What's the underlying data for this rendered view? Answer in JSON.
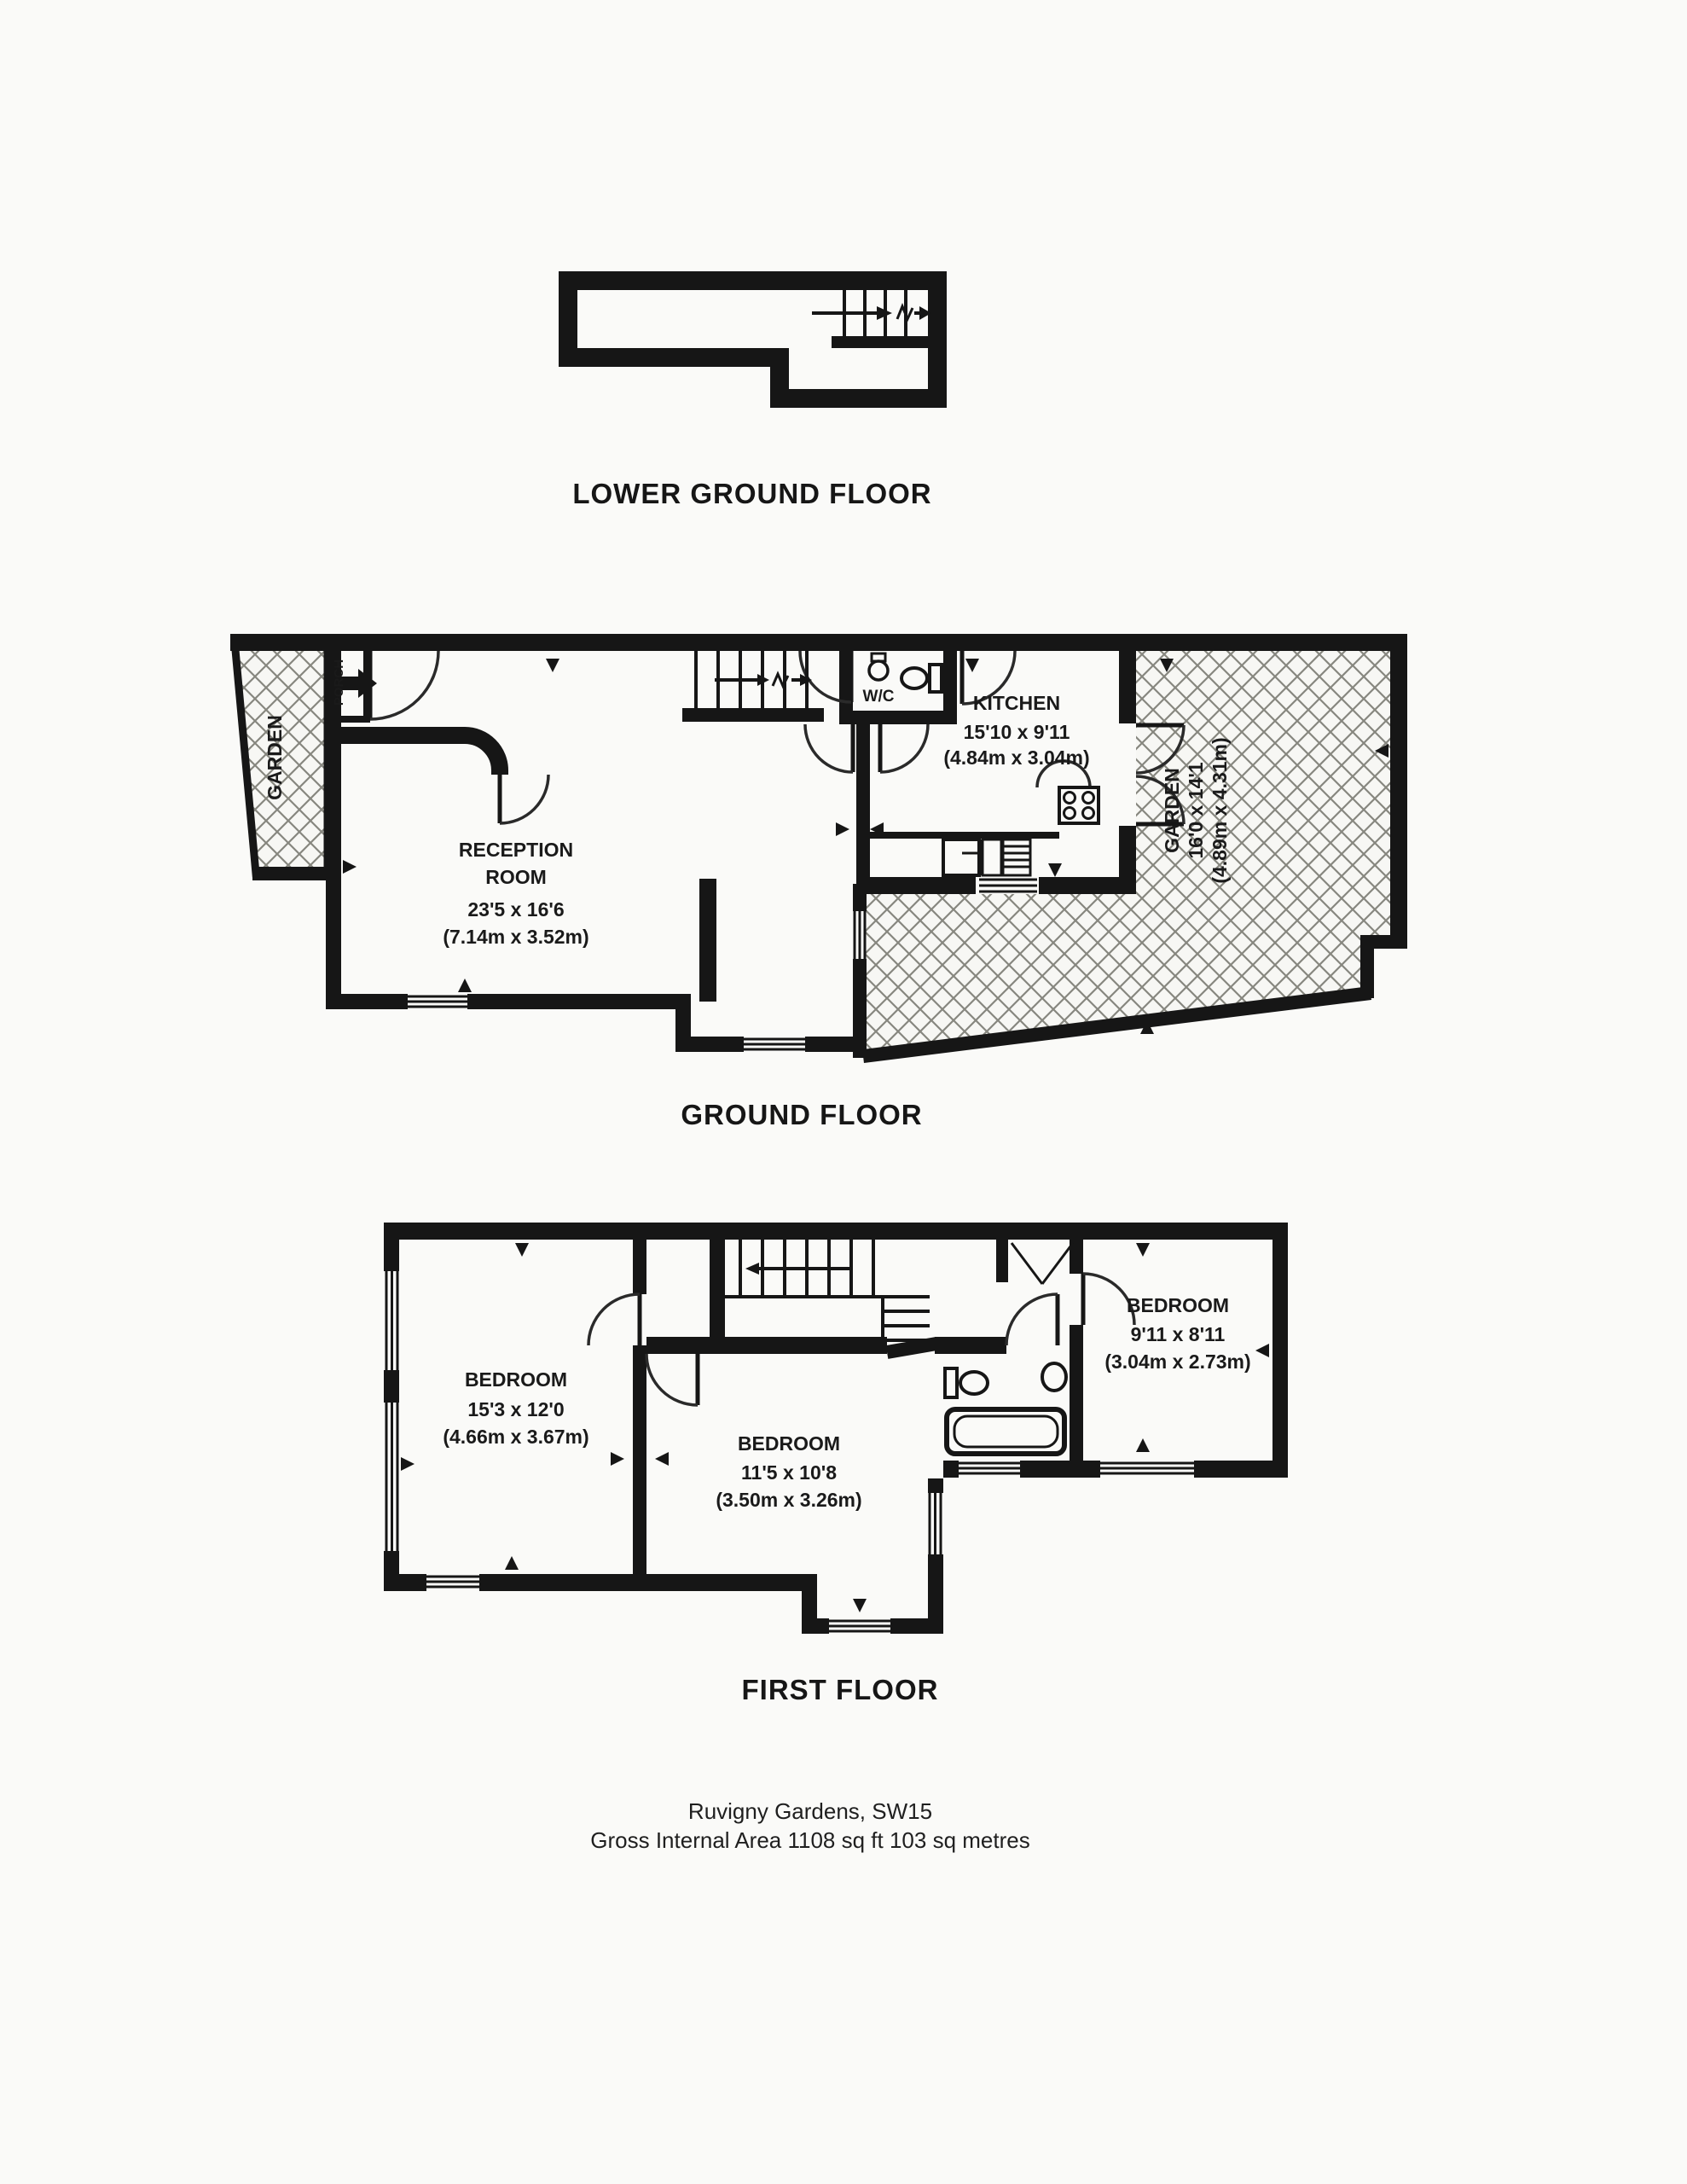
{
  "document": {
    "type": "estate-agent floor plan",
    "floors_order": [
      "LOWER GROUND FLOOR",
      "GROUND FLOOR",
      "FIRST FLOOR"
    ]
  },
  "colors": {
    "ink": "#161616",
    "paper": "#fafaf8",
    "hatch_line": "#87877f"
  },
  "symbols": {
    "stairs": "parallel-tread stairs icon with direction arrow and break line",
    "door": "quarter-circle swing arc",
    "window": "triple parallel line glyph in wall",
    "garden_surface": "diagonal crosshatch fill",
    "entry": "solid right-pointing entry arrow",
    "dimension_marker": "small solid triangle wall pointer"
  },
  "floors": {
    "lower_ground": {
      "title": "LOWER GROUND FLOOR"
    },
    "ground": {
      "title": "GROUND FLOOR",
      "garden_left": {
        "name": "GARDEN"
      },
      "porch": {
        "name": "PORCH"
      },
      "wc": {
        "name": "W/C"
      },
      "kitchen": {
        "name": "KITCHEN",
        "imperial": "15'10 x 9'11",
        "metric": "(4.84m x 3.04m)"
      },
      "reception": {
        "name_line1": "RECEPTION",
        "name_line2": "ROOM",
        "imperial": "23'5 x 16'6",
        "metric": "(7.14m x 3.52m)"
      },
      "garden_right": {
        "name": "GARDEN",
        "imperial": "16'0 x 14'1",
        "metric": "(4.89m x 4.31m)"
      }
    },
    "first": {
      "title": "FIRST FLOOR",
      "bedroom_front": {
        "name": "BEDROOM",
        "imperial": "15'3 x 12'0",
        "metric": "(4.66m x 3.67m)"
      },
      "bedroom_middle": {
        "name": "BEDROOM",
        "imperial": "11'5 x 10'8",
        "metric": "(3.50m x 3.26m)"
      },
      "bedroom_back": {
        "name": "BEDROOM",
        "imperial": "9'11 x 8'11",
        "metric": "(3.04m x 2.73m)"
      }
    }
  },
  "footer": {
    "address_line": "Ruvigny Gardens, SW15",
    "area_line": "Gross Internal Area 1108 sq ft 103 sq metres"
  }
}
